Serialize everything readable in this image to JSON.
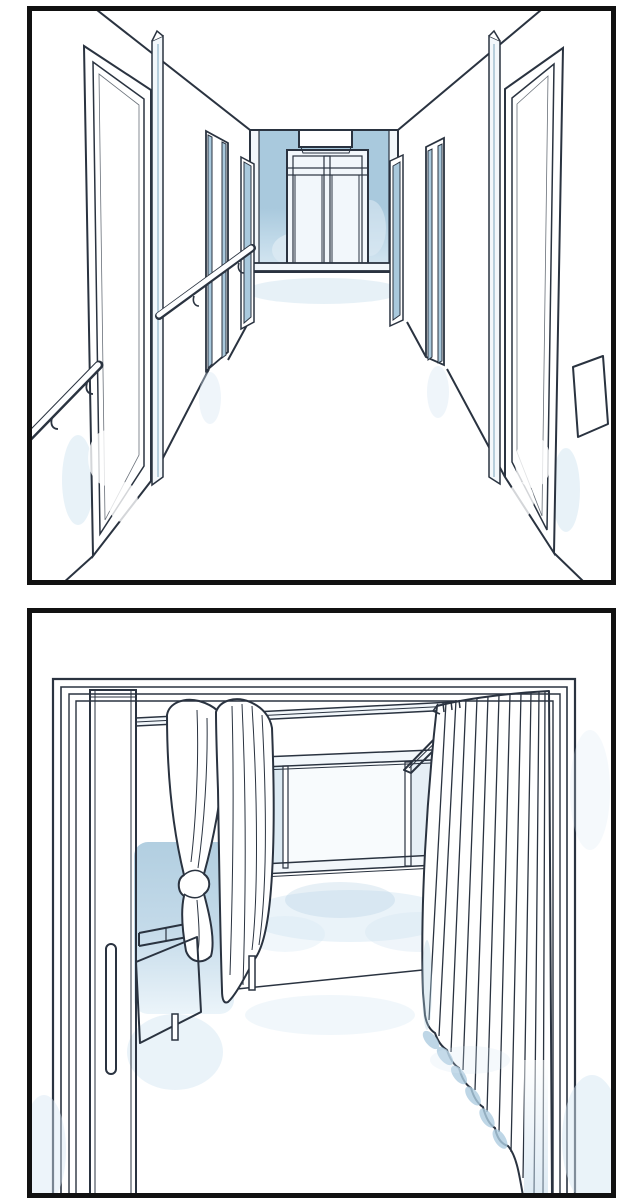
{
  "scene": {
    "type": "two-panel comic illustration",
    "subject": "hospital interior",
    "visible_text": "none"
  },
  "panels": [
    {
      "name": "corridor-panel",
      "description": "Hospital corridor in one-point perspective: blue doors on both walls, tubular handrails, blue end wall with white double doors and a blank sign above"
    },
    {
      "name": "room-panel",
      "description": "Hospital room seen through an open sliding door with a long vertical handle: bed behind a tied privacy curtain, rear band window with open transom, full-length pleated curtain on the right"
    }
  ],
  "palette": {
    "paper": "#ffffff",
    "border": "#111111",
    "ink": "#2a3340",
    "blue": "#a9c9dd",
    "blue_deep": "#8fb3c9",
    "blue_pale": "#dceaf3",
    "frame_light": "#f2f7fb",
    "pane_center": "#f8fbfd",
    "pane_side": "#e6eff6",
    "wash": "#aecde0",
    "wash_light": "#d6e7f3",
    "floor_glow": "#e4eff6"
  },
  "gradients": {
    "doorGrad": [
      [
        "0",
        "#a9c9dd"
      ],
      [
        "0.60",
        "#a9c9dd"
      ],
      [
        "0.80",
        "#cfe2ee"
      ],
      [
        "1",
        "#eef5fa"
      ]
    ],
    "endWallGrad": [
      [
        "0",
        "#a9c9dd"
      ],
      [
        "0.55",
        "#a9c9dd"
      ],
      [
        "0.80",
        "#c3dbea"
      ],
      [
        "1",
        "#d8e8f2"
      ]
    ],
    "shadowGrad": [
      [
        "0",
        "#a9c9dd"
      ],
      [
        "0.50",
        "#bdd6e7"
      ],
      [
        "1",
        "#e9f3f9"
      ]
    ],
    "curtWash": [
      [
        "0",
        "#ffffff"
      ],
      [
        "1",
        "#bcd6e8"
      ]
    ]
  }
}
